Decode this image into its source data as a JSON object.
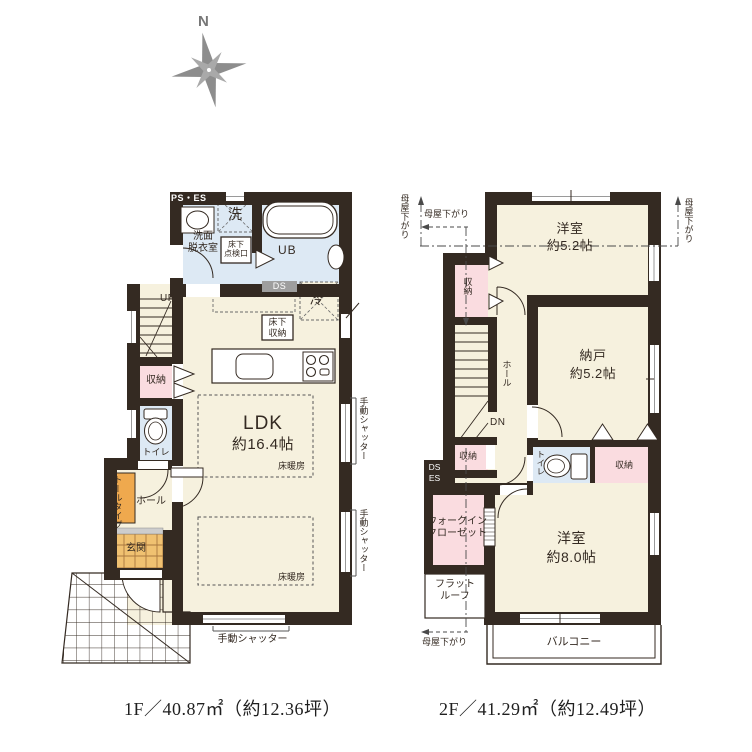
{
  "compass": {
    "north_label": "N"
  },
  "palette": {
    "wall": "#342a22",
    "floor_cream": "#f6f1de",
    "wet_blue": "#dde9f4",
    "closet_pink": "#fadce0",
    "genkan_tile": "#f0c171",
    "tall_cabinet_orange": "#efa94e",
    "duct_gray": "#9e9e9e",
    "compass_gray": "#8d8d8d"
  },
  "floor1": {
    "caption": "1F／40.87㎡（約12.36坪）",
    "rooms": {
      "ldk": {
        "name": "LDK",
        "size": "約16.4帖"
      },
      "washroom": "洗面\n脱衣室",
      "unit_bath": "UB",
      "toilet": "トイレ",
      "storage": "収納",
      "hall": "ホール",
      "entrance": "玄関"
    },
    "labels": {
      "ps_es": "PS・ES",
      "ds": "DS",
      "laundry": "洗",
      "fridge": "冷",
      "up": "UP",
      "underfloor_access": "床下\n点検口",
      "underfloor_storage": "床下\n収納",
      "floor_heating": "床暖房",
      "tall_type": "トールタイプ",
      "manual_shutter": "手動シャッター"
    }
  },
  "floor2": {
    "caption": "2F／41.29㎡（約12.49坪）",
    "rooms": {
      "bedroom_52": {
        "name": "洋室",
        "size": "約5.2帖"
      },
      "nando": {
        "name": "納戸",
        "size": "約5.2帖"
      },
      "bedroom_80": {
        "name": "洋室",
        "size": "約8.0帖"
      },
      "wic": "ウォークイン\nクローゼット",
      "balcony": "バルコニー",
      "hall": "ホール",
      "toilet": "トイレ",
      "storage": "収納",
      "flat_roof": "フラット\nルーフ"
    },
    "labels": {
      "dn": "DN",
      "ds_es": "DS\nES",
      "moya_sagari": "母屋下がり"
    }
  }
}
